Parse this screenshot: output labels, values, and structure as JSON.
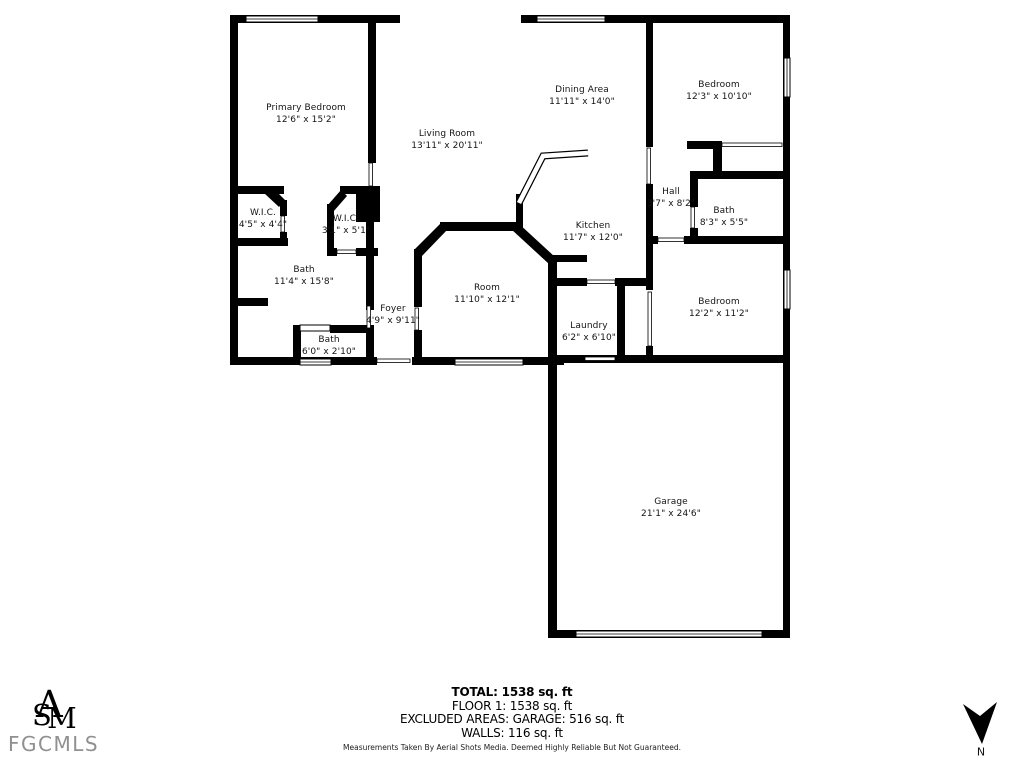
{
  "rooms": [
    {
      "id": "primary-bedroom",
      "name": "Primary Bedroom",
      "dims": "12'6\" x 15'2\""
    },
    {
      "id": "living-room",
      "name": "Living Room",
      "dims": "13'11\" x 20'11\""
    },
    {
      "id": "dining-area",
      "name": "Dining Area",
      "dims": "11'11\" x 14'0\""
    },
    {
      "id": "bedroom-1",
      "name": "Bedroom",
      "dims": "12'3\" x 10'10\""
    },
    {
      "id": "wic-1",
      "name": "W.I.C.",
      "dims": "4'5\" x 4'4\""
    },
    {
      "id": "wic-2",
      "name": "W.I.C.",
      "dims": "3'1\" x 5'1\""
    },
    {
      "id": "hall",
      "name": "Hall",
      "dims": "3'7\" x 8'2\""
    },
    {
      "id": "bath-1",
      "name": "Bath",
      "dims": "8'3\" x 5'5\""
    },
    {
      "id": "kitchen",
      "name": "Kitchen",
      "dims": "11'7\" x 12'0\""
    },
    {
      "id": "bath-2",
      "name": "Bath",
      "dims": "11'4\" x 15'8\""
    },
    {
      "id": "room",
      "name": "Room",
      "dims": "11'10\" x 12'1\""
    },
    {
      "id": "foyer",
      "name": "Foyer",
      "dims": "4'9\" x 9'11\""
    },
    {
      "id": "laundry",
      "name": "Laundry",
      "dims": "6'2\" x 6'10\""
    },
    {
      "id": "bedroom-2",
      "name": "Bedroom",
      "dims": "12'2\" x 11'2\""
    },
    {
      "id": "bath-3",
      "name": "Bath",
      "dims": "6'0\" x 2'10\""
    },
    {
      "id": "garage",
      "name": "Garage",
      "dims": "21'1\" x 24'6\""
    }
  ],
  "summary": {
    "total": "TOTAL: 1538 sq. ft",
    "floor1": "FLOOR 1: 1538 sq. ft",
    "excluded": "EXCLUDED AREAS: GARAGE: 516 sq. ft",
    "walls": "WALLS: 116 sq. ft"
  },
  "disclaimer": "Measurements Taken By Aerial Shots Media. Deemed Highly Reliable But Not Guaranteed.",
  "branding": {
    "monogram_a": "A",
    "monogram_s": "S",
    "monogram_m": "M",
    "logo_text": "FGCMLS"
  },
  "compass": {
    "label": "N"
  },
  "colors": {
    "wall": "#000000",
    "logo_text": "#909090"
  }
}
